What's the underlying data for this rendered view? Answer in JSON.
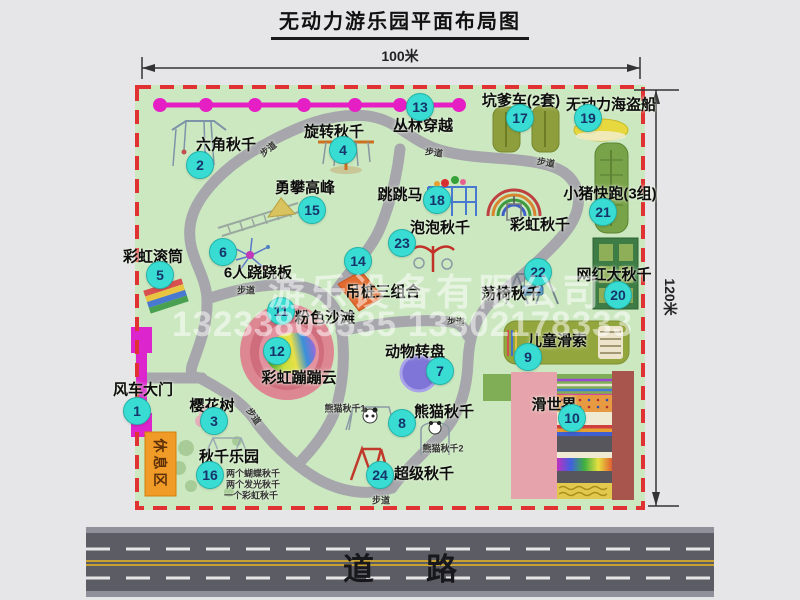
{
  "title": "无动力游乐园平面布局图",
  "dim_top": "100米",
  "dim_right": "120米",
  "road_label": "道路",
  "rest_area_label": "休息区",
  "watermark": {
    "line1": "游乐设备有限公司",
    "line2": "13233805535 13302178333"
  },
  "colors": {
    "map_bg": "#cbe8c0",
    "border_red": "#e03232",
    "path_gray": "#a6a6ac",
    "marker": "#38dcd2",
    "zipline": "#e51fc4",
    "gate": "#dc25cd",
    "rest_area": "#f09b28",
    "road": "#5c5c65"
  },
  "attractions": [
    {
      "num": "1",
      "name": "风车大门",
      "cx": 137,
      "cy": 411,
      "lx": 143,
      "ly": 389
    },
    {
      "num": "2",
      "name": "六角秋千",
      "cx": 200,
      "cy": 165,
      "lx": 226,
      "ly": 144
    },
    {
      "num": "3",
      "name": "樱花树",
      "cx": 214,
      "cy": 421,
      "lx": 212,
      "ly": 405
    },
    {
      "num": "4",
      "name": "旋转秋千",
      "cx": 343,
      "cy": 150,
      "lx": 334,
      "ly": 131
    },
    {
      "num": "5",
      "name": "彩虹滚筒",
      "cx": 160,
      "cy": 275,
      "lx": 153,
      "ly": 256
    },
    {
      "num": "6",
      "name": "6人跷跷板",
      "cx": 223,
      "cy": 252,
      "lx": 258,
      "ly": 272
    },
    {
      "num": "7",
      "name": "动物转盘",
      "cx": 440,
      "cy": 371,
      "lx": 415,
      "ly": 351
    },
    {
      "num": "8",
      "name": "熊猫秋千",
      "cx": 402,
      "cy": 423,
      "lx": 444,
      "ly": 411
    },
    {
      "num": "9",
      "name": "儿童滑索",
      "cx": 528,
      "cy": 357,
      "lx": 557,
      "ly": 340
    },
    {
      "num": "10",
      "name": "滑世界",
      "cx": 572,
      "cy": 418,
      "lx": 554,
      "ly": 404
    },
    {
      "num": "11",
      "name": "粉色沙滩",
      "cx": 281,
      "cy": 311,
      "lx": 325,
      "ly": 317
    },
    {
      "num": "12",
      "name": "彩虹蹦蹦云",
      "cx": 277,
      "cy": 351,
      "lx": 299,
      "ly": 377
    },
    {
      "num": "13",
      "name": "丛林穿越",
      "cx": 420,
      "cy": 107,
      "lx": 423,
      "ly": 125
    },
    {
      "num": "14",
      "name": "吊桩三组合",
      "cx": 358,
      "cy": 261,
      "lx": 383,
      "ly": 291
    },
    {
      "num": "15",
      "name": "勇攀高峰",
      "cx": 312,
      "cy": 210,
      "lx": 305,
      "ly": 187
    },
    {
      "num": "16",
      "name": "秋千乐园",
      "cx": 210,
      "cy": 475,
      "lx": 229,
      "ly": 456
    },
    {
      "num": "17",
      "name": "坑爹车(2套)",
      "cx": 520,
      "cy": 118,
      "lx": 521,
      "ly": 100
    },
    {
      "num": "18",
      "name": "跳跳马",
      "cx": 437,
      "cy": 200,
      "lx": 400,
      "ly": 194
    },
    {
      "num": "19",
      "name": "无动力海盗船",
      "cx": 588,
      "cy": 118,
      "lx": 611,
      "ly": 104
    },
    {
      "num": "20",
      "name": "网红大秋千",
      "cx": 618,
      "cy": 295,
      "lx": 614,
      "ly": 274
    },
    {
      "num": "21",
      "name": "小猪快跑(3组)",
      "cx": 603,
      "cy": 212,
      "lx": 610,
      "ly": 193
    },
    {
      "num": "22",
      "name": "荡椅秋千",
      "cx": 538,
      "cy": 272,
      "lx": 511,
      "ly": 293
    },
    {
      "num": "23",
      "name": "泡泡秋千",
      "cx": 402,
      "cy": 243,
      "lx": 440,
      "ly": 227
    },
    {
      "num": "24",
      "name": "超级秋千",
      "cx": 380,
      "cy": 475,
      "lx": 424,
      "ly": 473
    }
  ],
  "extra_labels": [
    {
      "text": "彩虹秋千",
      "x": 540,
      "y": 224,
      "size": 15,
      "bold": true,
      "rot": 0
    },
    {
      "text": "熊猫秋千1",
      "x": 345,
      "y": 408,
      "size": 9,
      "bold": true,
      "rot": 0
    },
    {
      "text": "熊猫秋千2",
      "x": 443,
      "y": 448,
      "size": 9,
      "bold": true,
      "rot": 0
    },
    {
      "text": "两个蝴蝶秋千",
      "x": 253,
      "y": 473,
      "size": 9,
      "bold": false,
      "rot": 0
    },
    {
      "text": "两个发光秋千",
      "x": 253,
      "y": 484,
      "size": 9,
      "bold": false,
      "rot": 0
    },
    {
      "text": "一个彩虹秋千",
      "x": 251,
      "y": 495,
      "size": 9,
      "bold": false,
      "rot": 0
    },
    {
      "text": "步道",
      "x": 268,
      "y": 149,
      "size": 9,
      "bold": true,
      "rot": -38
    },
    {
      "text": "步道",
      "x": 434,
      "y": 152,
      "size": 9,
      "bold": true,
      "rot": 8
    },
    {
      "text": "步道",
      "x": 546,
      "y": 162,
      "size": 9,
      "bold": true,
      "rot": 10
    },
    {
      "text": "步道",
      "x": 246,
      "y": 290,
      "size": 9,
      "bold": true,
      "rot": 0
    },
    {
      "text": "步道",
      "x": 456,
      "y": 321,
      "size": 9,
      "bold": true,
      "rot": 5
    },
    {
      "text": "步道",
      "x": 254,
      "y": 416,
      "size": 9,
      "bold": true,
      "rot": 55
    },
    {
      "text": "步道",
      "x": 381,
      "y": 500,
      "size": 9,
      "bold": true,
      "rot": 0
    }
  ]
}
